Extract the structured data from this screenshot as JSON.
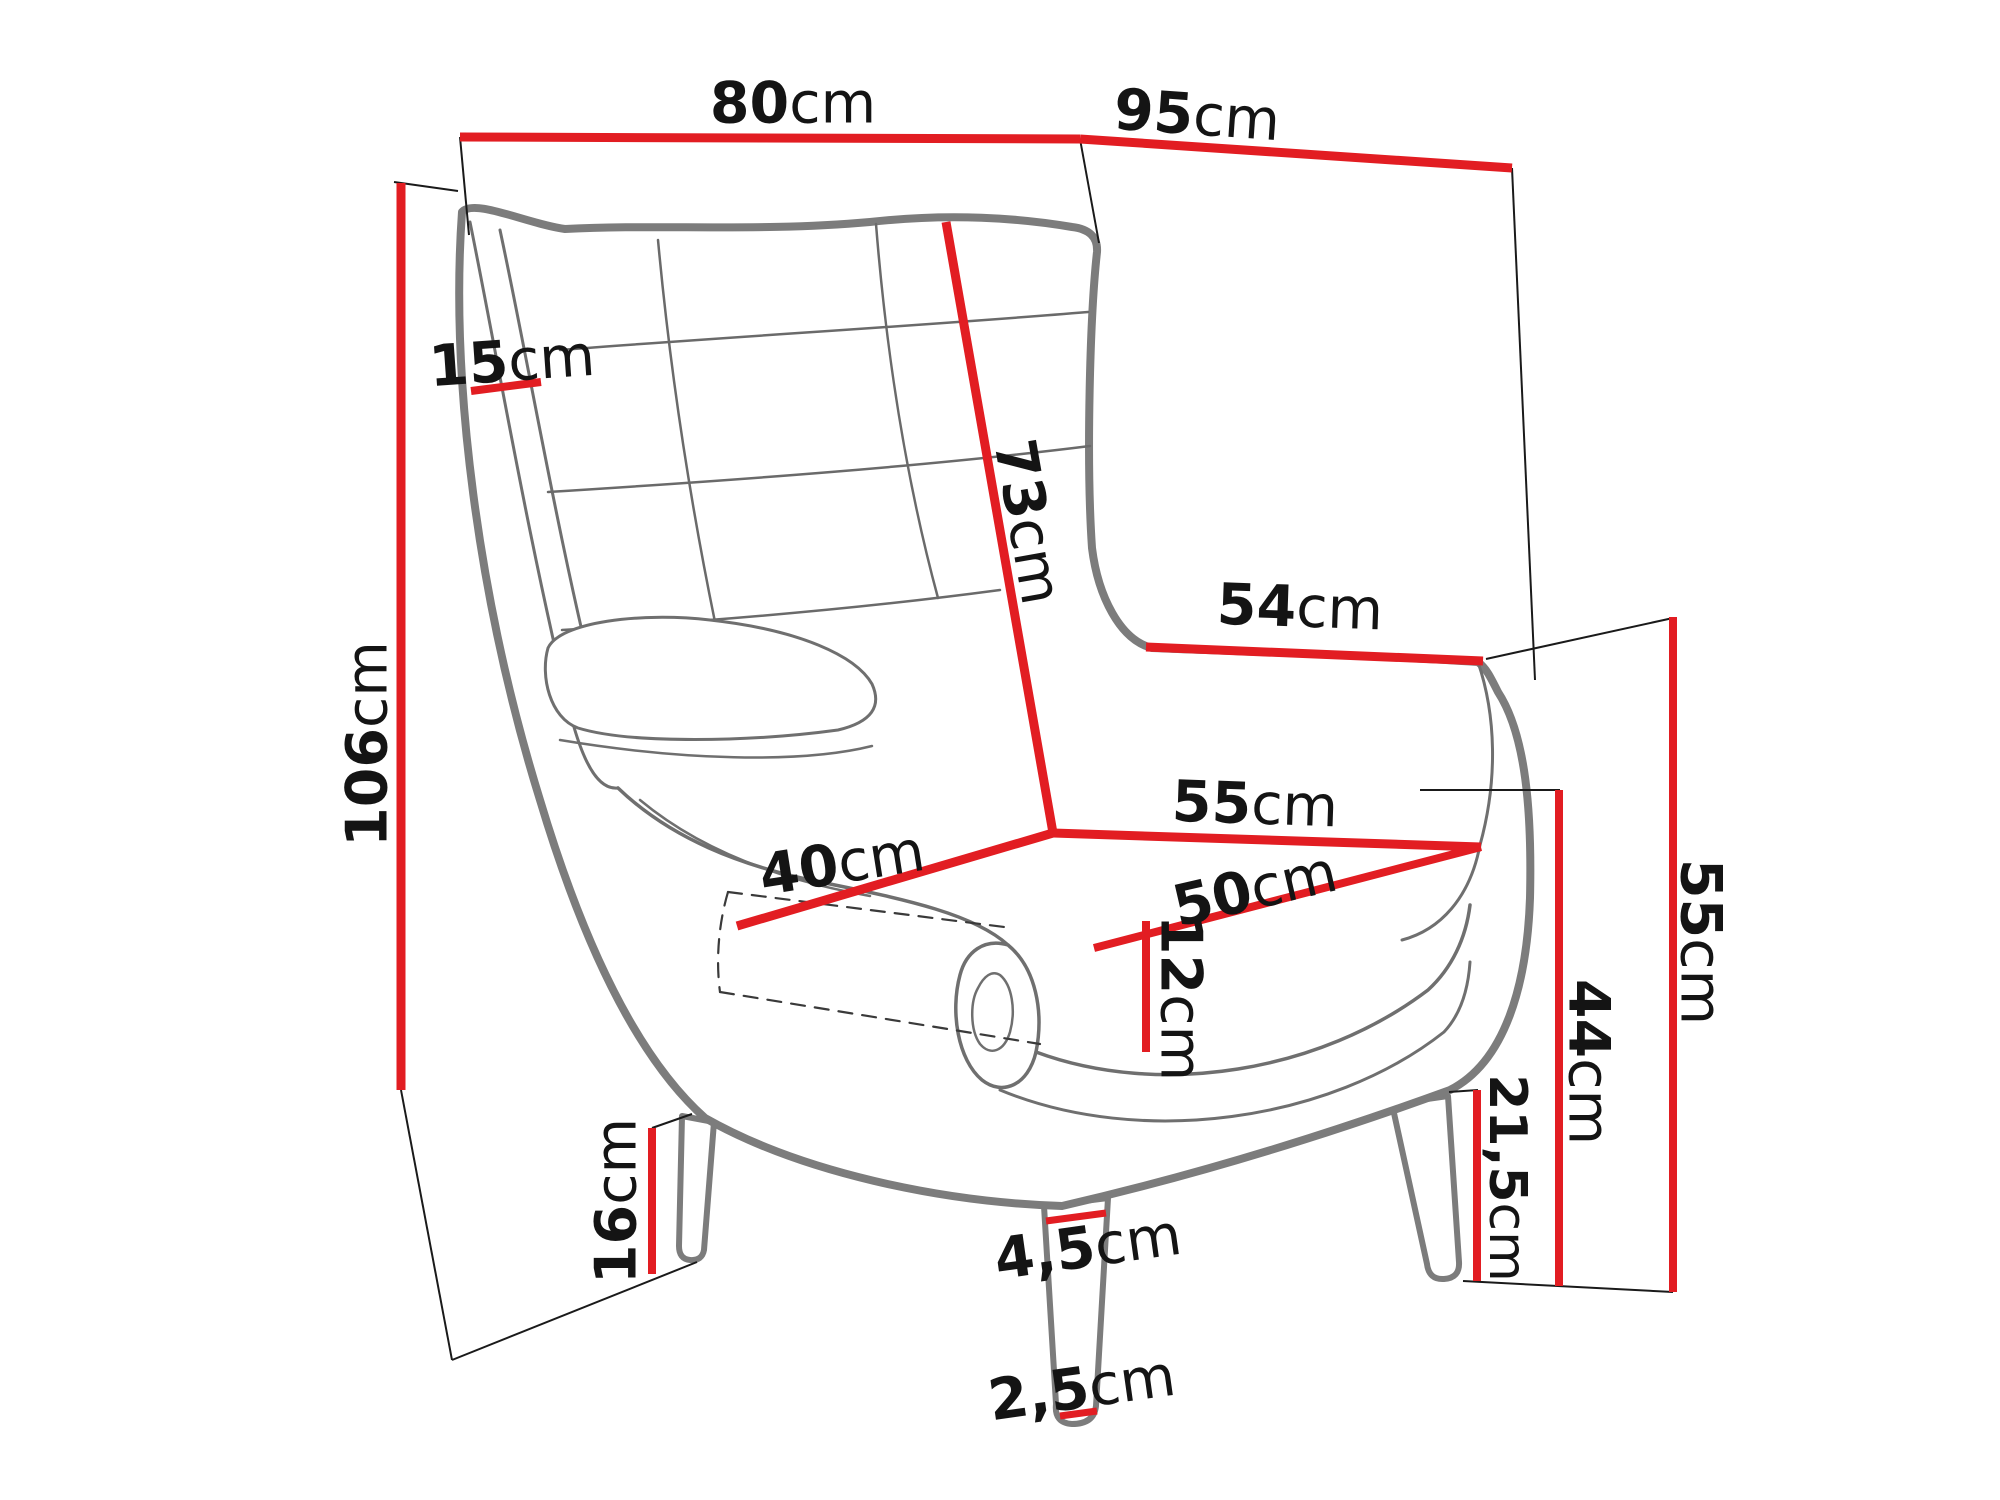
{
  "diagram": {
    "subject": "wingback-armchair-dimensions",
    "unit_default": "cm",
    "colors": {
      "dimension_line": "#e21d22",
      "chair_outline": "#7c7c7c",
      "chair_detail": "#6f6f6f",
      "guide_line": "#1a1a1a",
      "label_text": "#141414",
      "background": "#ffffff"
    },
    "dims": {
      "width_top": {
        "value": "80",
        "unit": "cm"
      },
      "depth_top": {
        "value": "95",
        "unit": "cm"
      },
      "height_total": {
        "value": "106",
        "unit": "cm"
      },
      "wing_width": {
        "value": "15",
        "unit": "cm"
      },
      "backrest_height": {
        "value": "73",
        "unit": "cm"
      },
      "arm_depth": {
        "value": "54",
        "unit": "cm"
      },
      "seat_width": {
        "value": "55",
        "unit": "cm"
      },
      "seat_depth": {
        "value": "50",
        "unit": "cm"
      },
      "seat_depth_side": {
        "value": "40",
        "unit": "cm"
      },
      "cushion_height": {
        "value": "12",
        "unit": "cm"
      },
      "seat_height": {
        "value": "44",
        "unit": "cm"
      },
      "arm_height": {
        "value": "55",
        "unit": "cm"
      },
      "leg_clearance": {
        "value": "21,5",
        "unit": "cm"
      },
      "leg_height": {
        "value": "16",
        "unit": "cm"
      },
      "leg_width_top": {
        "value": "4,5",
        "unit": "cm"
      },
      "leg_width_bottom": {
        "value": "2,5",
        "unit": "cm"
      }
    }
  }
}
